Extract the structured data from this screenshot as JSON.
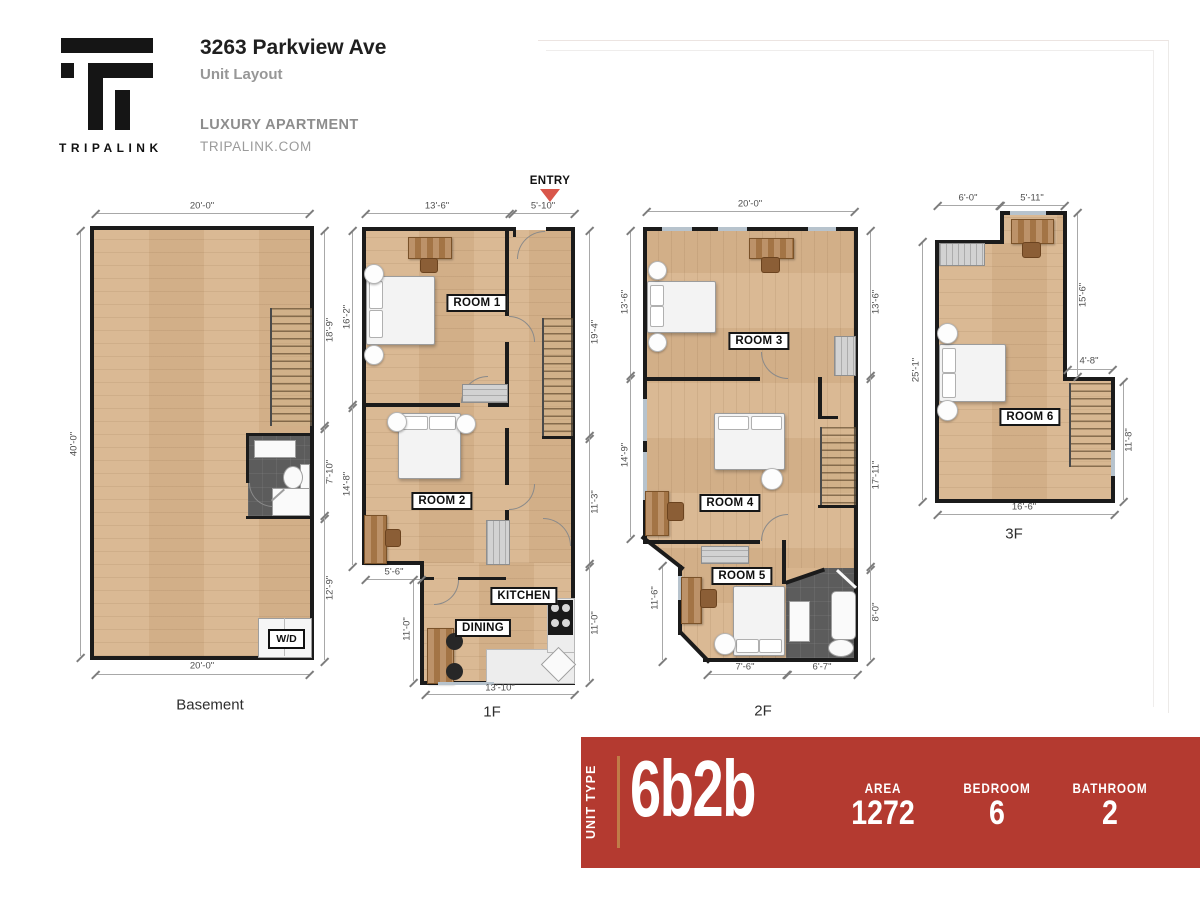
{
  "header": {
    "brand": "TRIPALINK",
    "title": "3263 Parkview Ave",
    "subtitle": "Unit Layout",
    "line1": "LUXURY APARTMENT",
    "line2": "TRIPALINK.COM"
  },
  "floors": {
    "basement": {
      "name": "Basement",
      "wd": "W/D",
      "dim_top": "20'-0\"",
      "dim_left": "40'-0\"",
      "dim_r1": "18'-9\"",
      "dim_r2": "7'-10\"",
      "dim_r3": "12'-9\"",
      "dim_bottom": "20'-0\""
    },
    "f1": {
      "name": "1F",
      "entry": "ENTRY",
      "room1": "ROOM 1",
      "room2": "ROOM 2",
      "kitchen": "KITCHEN",
      "dining": "DINING",
      "dim_t1": "13'-6\"",
      "dim_t2": "5'-10\"",
      "dim_l1": "16'-2\"",
      "dim_l2": "14'-8\"",
      "dim_l3": "5'-6\"",
      "dim_l4": "11'-0\"",
      "dim_r1": "19'-4\"",
      "dim_r2": "11'-3\"",
      "dim_r3": "11'-0\"",
      "dim_b": "13'-10\""
    },
    "f2": {
      "name": "2F",
      "room3": "ROOM 3",
      "room4": "ROOM 4",
      "room5": "ROOM 5",
      "dim_t": "20'-0\"",
      "dim_l1": "13'-6\"",
      "dim_l2": "14'-9\"",
      "dim_l3": "11'-6\"",
      "dim_r1": "13'-6\"",
      "dim_r2": "17'-11\"",
      "dim_r3": "8'-0\"",
      "dim_b1": "7'-6\"",
      "dim_b2": "6'-7\""
    },
    "f3": {
      "name": "3F",
      "room6": "ROOM 6",
      "dim_t1": "6'-0\"",
      "dim_t2": "5'-11\"",
      "dim_l": "25'-1\"",
      "dim_r1": "15'-6\"",
      "dim_r2": "4'-8\"",
      "dim_r3": "11'-8\"",
      "dim_b": "16'-6\""
    }
  },
  "banner": {
    "unit_type_label": "UNIT TYPE",
    "unit_type": "6b2b",
    "stats": [
      {
        "label": "AREA",
        "value": "1272"
      },
      {
        "label": "BEDROOM",
        "value": "6"
      },
      {
        "label": "BATHROOM",
        "value": "2"
      }
    ]
  },
  "colors": {
    "banner_bg": "#b43a30",
    "banner_accent_line": "#c07c48",
    "entry_arrow": "#d9564a",
    "wood_floor": "#d8b58e",
    "bathroom_tile": "#5c5c5c",
    "window": "#b7c3cd"
  }
}
